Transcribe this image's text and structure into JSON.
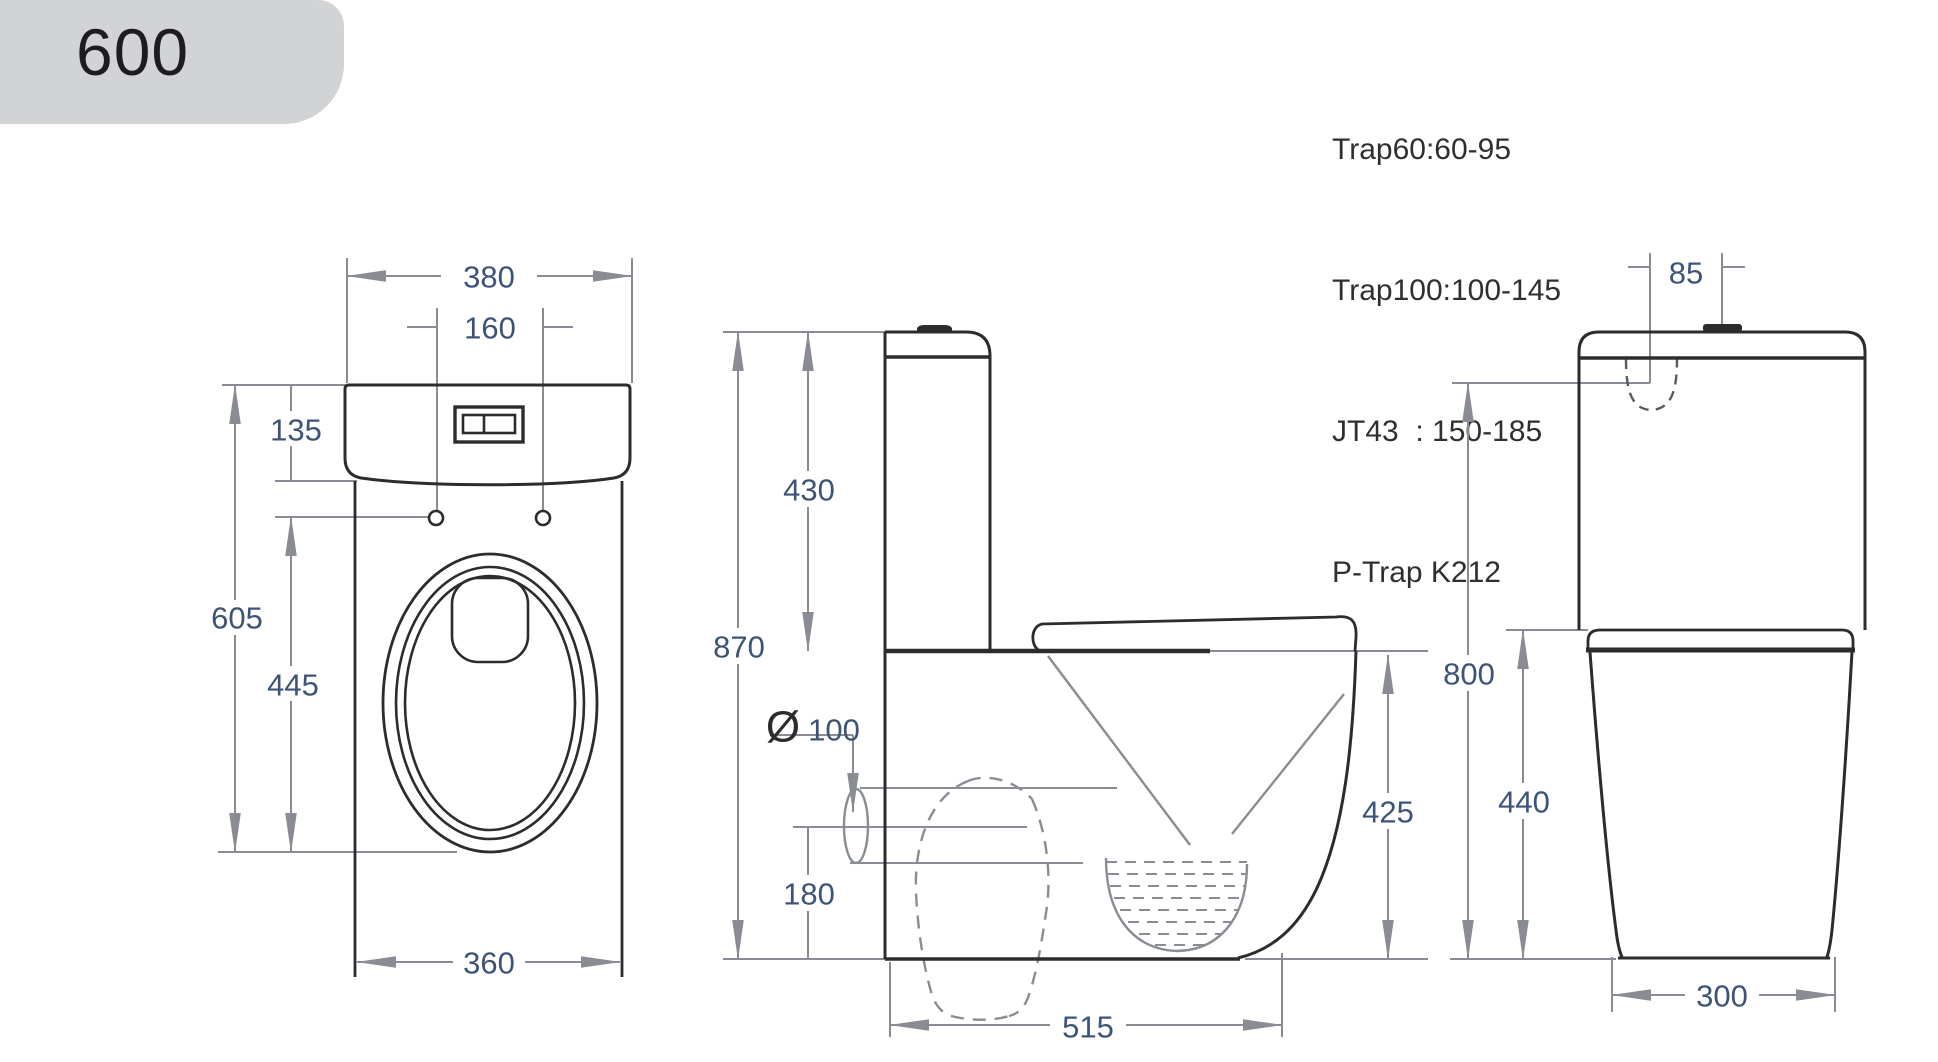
{
  "badge": {
    "label": "600"
  },
  "specs": {
    "lines": [
      "Trap60:60-95",
      "Trap100:100-145",
      "JT43  : 150-185",
      "P-Trap K212"
    ]
  },
  "dims": {
    "front": {
      "tank_width": "380",
      "hole_spacing": "160",
      "cistern_height": "135",
      "overall_depth": "605",
      "hole_to_front": "445",
      "base_width": "360"
    },
    "side": {
      "cistern_height": "430",
      "overall_height": "870",
      "outlet_symbol": "Ø",
      "outlet_diameter": "100",
      "outlet_axis_height": "180",
      "rim_height": "425",
      "depth_to_front": "515"
    },
    "rear": {
      "button_offset": "85",
      "overall_height": "800",
      "seat_height": "440",
      "base_width": "300"
    }
  },
  "colors": {
    "outline": "#2c2c2e",
    "dimension_lines": "#898d93",
    "dimension_text": "#3d5478",
    "badge_background": "#d2d3d5",
    "spec_text": "#2f2f31"
  }
}
